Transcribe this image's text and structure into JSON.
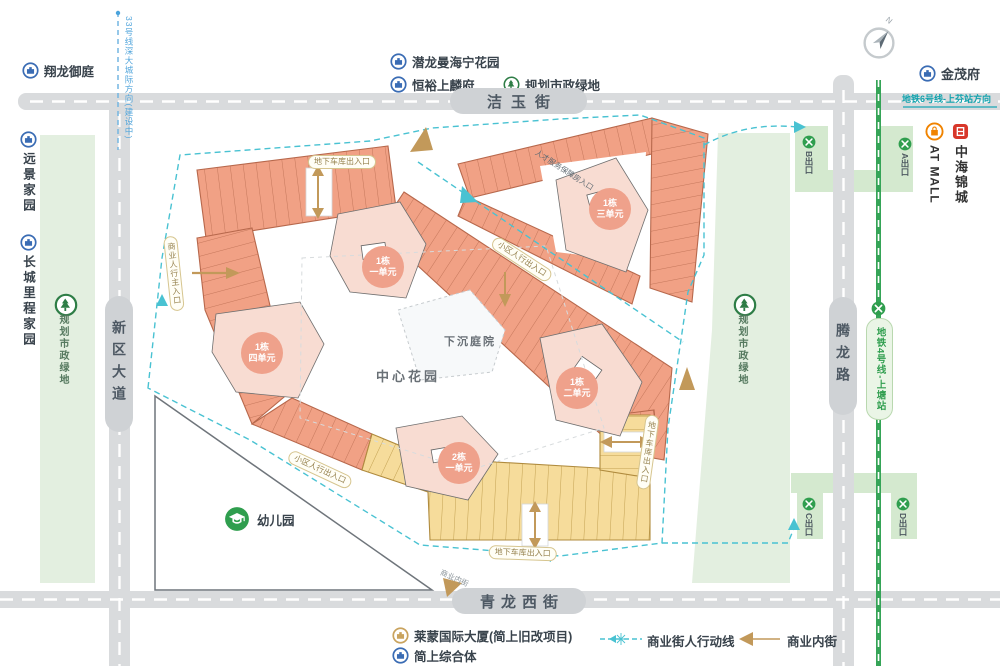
{
  "colors": {
    "road": "#d9dbdd",
    "road_capsule": "#cfd2d5",
    "building_orange": "#f1a185",
    "building_yellow": "#f6dc9b",
    "unit_pink": "#f8dcd2",
    "unit_circle": "#efa18b",
    "route_teal": "#49c2d2",
    "metro_green": "#2f9e4e",
    "green_area": "#e3efe0",
    "gold": "#c2995a",
    "label_dark": "#39434c",
    "brand_red": "#d8372a",
    "brand_orange": "#f08300",
    "icon_blue": "#2b5ca8",
    "line33_blue": "#53a6dc",
    "line6_teal": "#12a3ae"
  },
  "compass": {
    "north": "N"
  },
  "streets": {
    "jieyu": "洁玉街",
    "qinglongxi": "青龙西街",
    "xinqu": "新区大道",
    "tenglong": "腾龙路"
  },
  "transit": {
    "line33": "33号线深大城际方向(建设中)",
    "line6": "地铁6号线-上芬站方向",
    "line4": "地铁4号线-上塘站",
    "exit_a": "A出口",
    "exit_b": "B出口",
    "exit_c": "C出口",
    "exit_d": "D出口"
  },
  "neighbors": {
    "xianglong": "翔龙御庭",
    "yuanjing": "远景家园",
    "changcheng": "长城里程家园",
    "qianlong": "潜龙曼海宁花园",
    "hengyu": "恒裕上麟府",
    "jinmao": "金茂府",
    "at_mall": "AT MALL",
    "zhonghai": "中海锦城",
    "green": "规划市政绿地",
    "kindergarten": "幼儿园"
  },
  "site": {
    "central_garden": "中心花园",
    "sunken_courtyard": "下沉庭院",
    "units": [
      {
        "name": "1栋",
        "unit": "一单元"
      },
      {
        "name": "1栋",
        "unit": "二单元"
      },
      {
        "name": "1栋",
        "unit": "三单元"
      },
      {
        "name": "1栋",
        "unit": "四单元"
      },
      {
        "name": "2栋",
        "unit": "一单元"
      }
    ],
    "entrances": {
      "garage_top": "地下车库出入口",
      "garage_right": "地下车库出入口",
      "garage_bottom": "地下车库出入口",
      "pedestrian_main": "商业人行主入口",
      "residential_ne": "小区人行出入口",
      "residential_sw": "小区人行出入口",
      "talent_housing": "人才服务保障房入口"
    },
    "inner_street_note": "商业内街"
  },
  "legend": {
    "laimeng": "莱蒙国际大厦(简上旧改项目)",
    "jianshang": "简上综合体",
    "pedestrian_line": "商业街人行动线",
    "inner_street": "商业内街"
  }
}
